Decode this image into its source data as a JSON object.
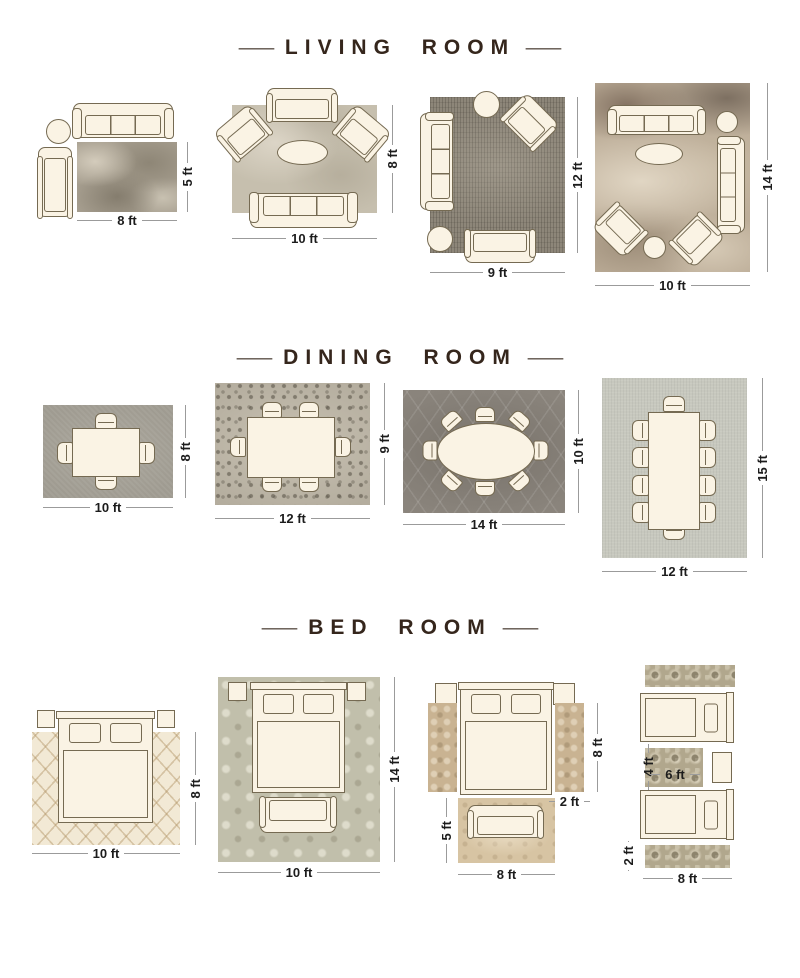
{
  "colors": {
    "background": "#ffffff",
    "title": "#35261c",
    "dimension_text": "#1c1c1c",
    "dimension_line": "#9b9b9b",
    "furniture_fill": "#faf3e4",
    "furniture_outline": "#756a52"
  },
  "sections": [
    {
      "id": "living-room",
      "title": "LIVING ROOM",
      "dash": "—",
      "layouts": [
        {
          "width": "8 ft",
          "height": "5 ft"
        },
        {
          "width": "10 ft",
          "height": "8 ft"
        },
        {
          "width": "9 ft",
          "height": "12 ft"
        },
        {
          "width": "10 ft",
          "height": "14 ft"
        }
      ]
    },
    {
      "id": "dining-room",
      "title": "DINING ROOM",
      "dash": "—",
      "layouts": [
        {
          "width": "10 ft",
          "height": "8 ft"
        },
        {
          "width": "12 ft",
          "height": "9 ft"
        },
        {
          "width": "14 ft",
          "height": "10 ft"
        },
        {
          "width": "12 ft",
          "height": "15 ft"
        }
      ]
    },
    {
      "id": "bed-room",
      "title": "BED ROOM",
      "dash": "—",
      "layouts": [
        {
          "width": "10 ft",
          "height": "8 ft"
        },
        {
          "width": "10 ft",
          "height": "14 ft"
        },
        {
          "runner_length": "8 ft",
          "runner_width": "2 ft",
          "foot_rug_height": "5 ft",
          "foot_rug_width": "8 ft"
        },
        {
          "mid_rug_height": "4 ft",
          "mid_rug_width": "6 ft",
          "runner_width": "2 ft",
          "runner_length": "8 ft"
        }
      ]
    }
  ]
}
